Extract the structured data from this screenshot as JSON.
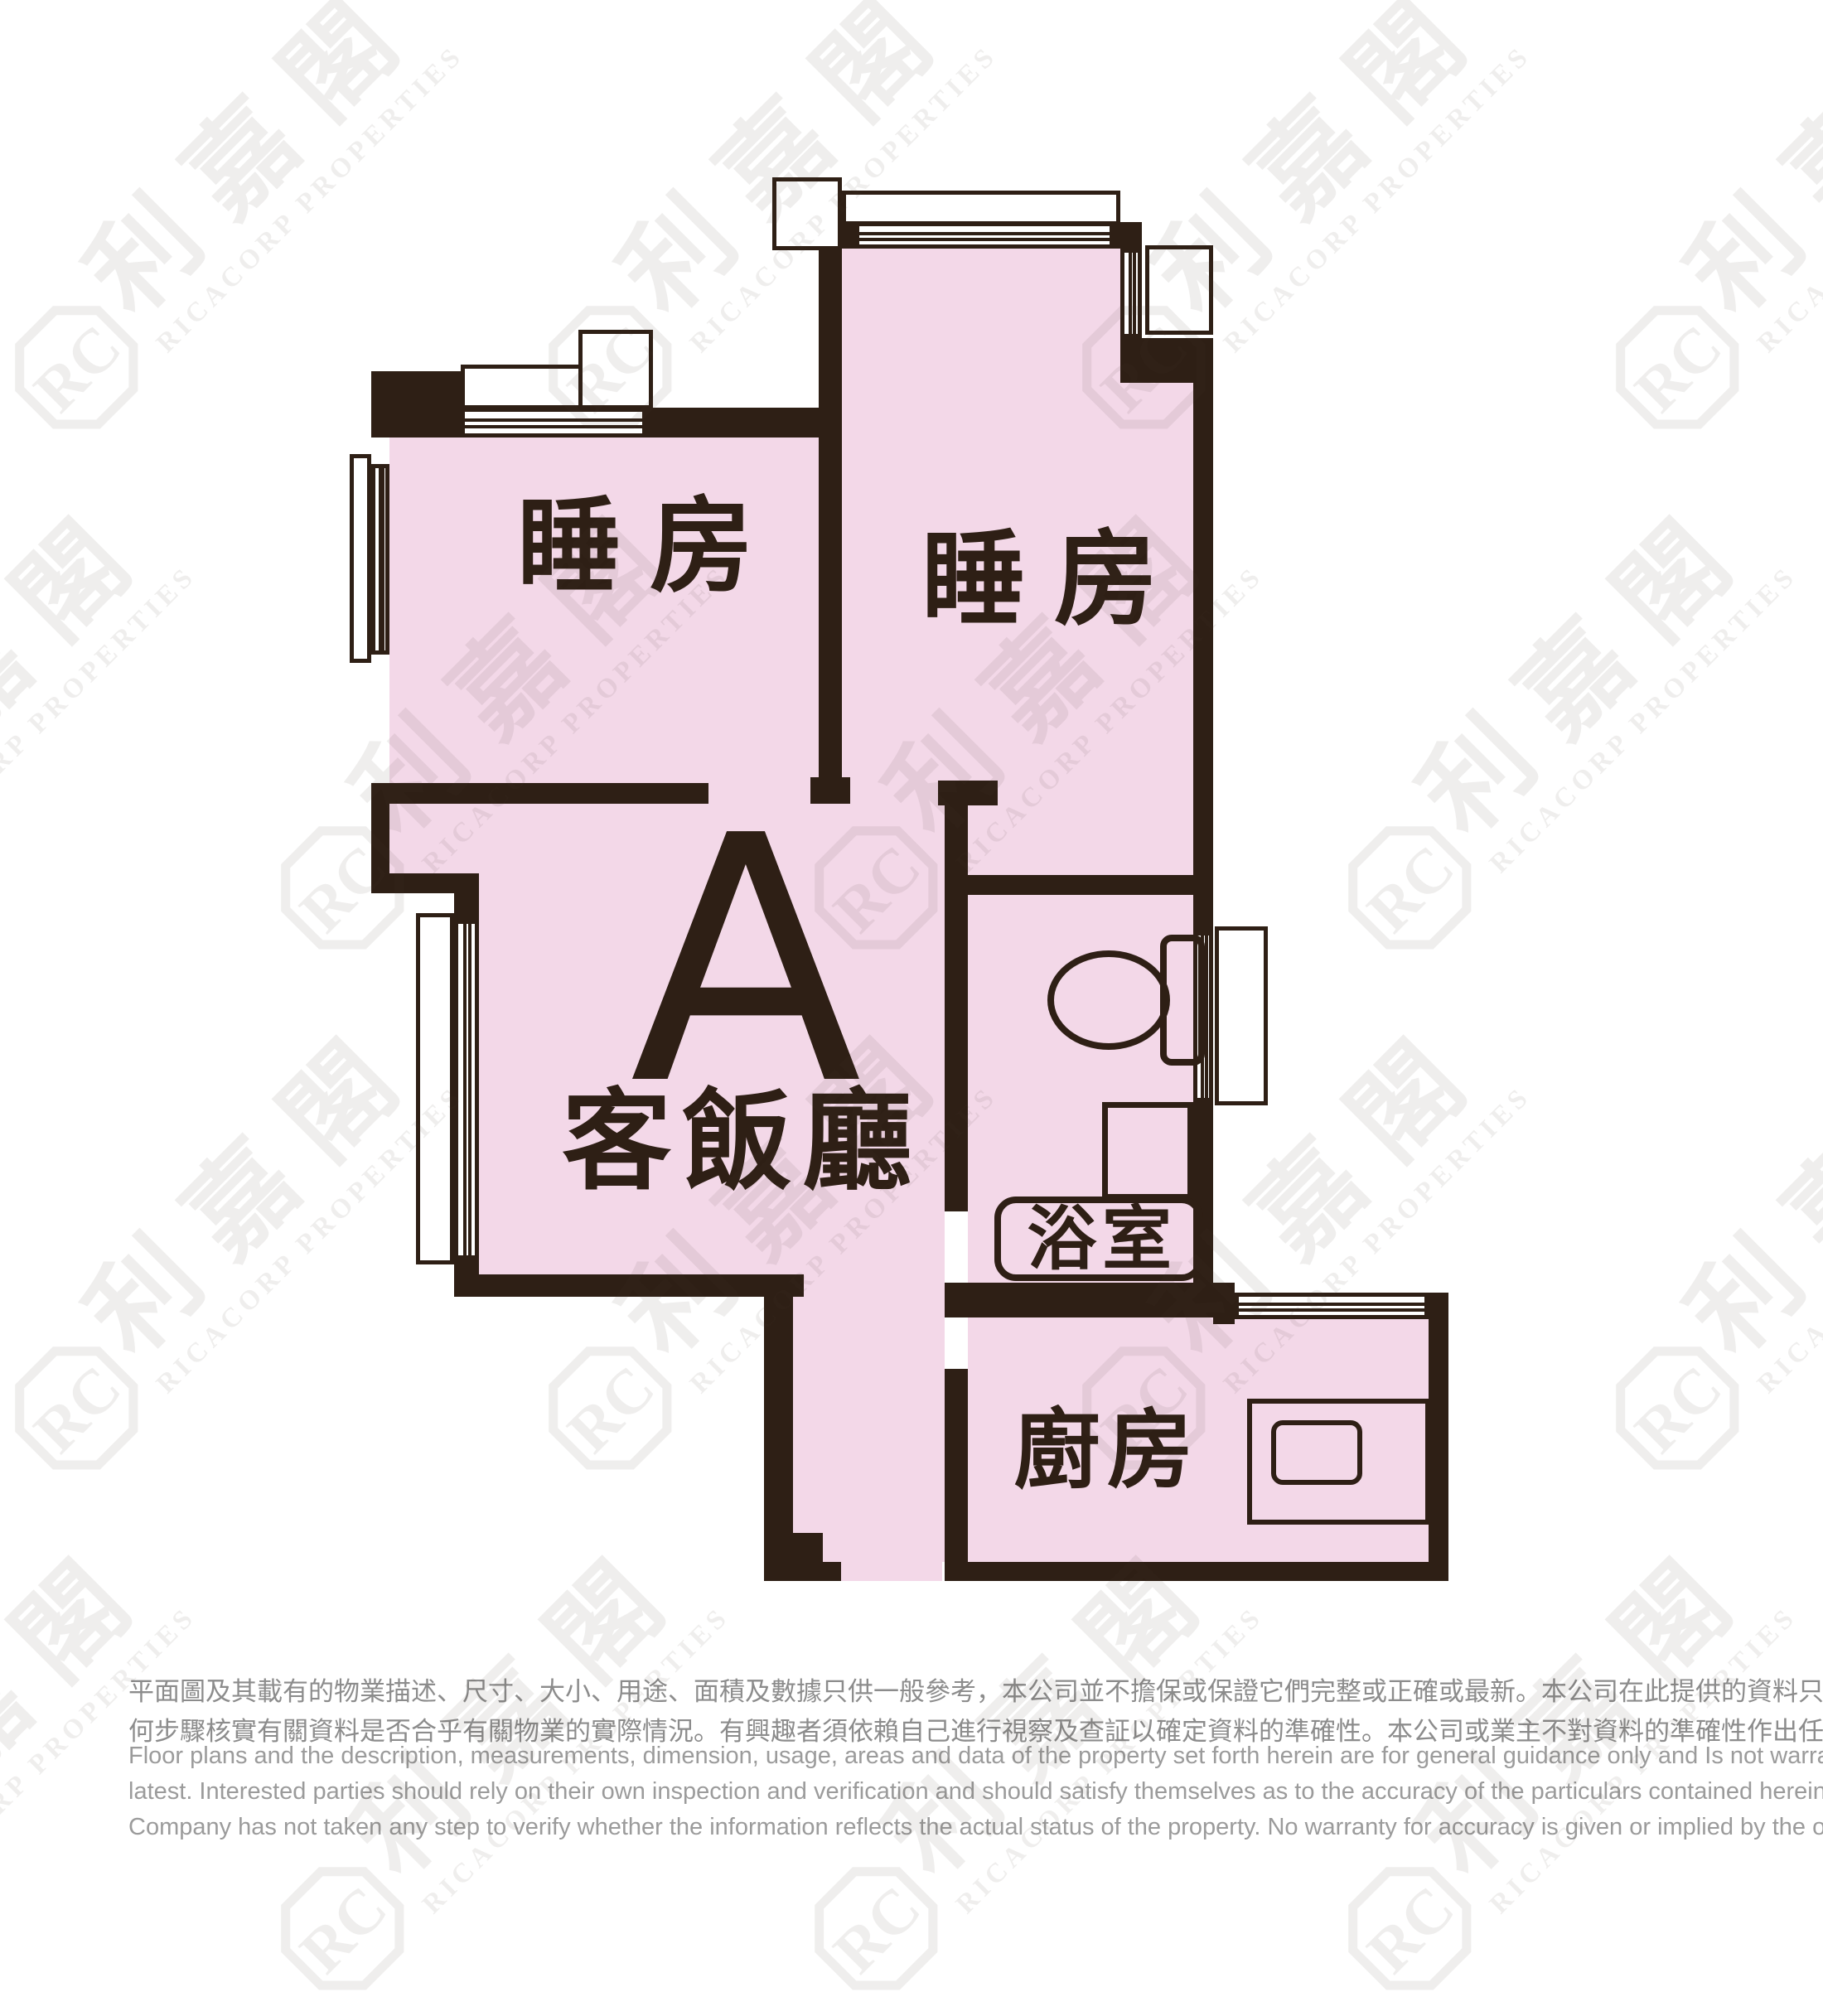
{
  "colors": {
    "wall": "#2e1f15",
    "room_fill": "#f3d8e8",
    "watermark": "rgba(70,58,50,0.085)",
    "disclaimer_zh": "#8c8c8c",
    "disclaimer_en": "#9b9b9b"
  },
  "watermark": {
    "logo_text": "RC",
    "name_cn": "利嘉閣",
    "name_en": "RICACORP PROPERTIES"
  },
  "plan": {
    "unit_label": "A",
    "rooms": {
      "bedroom_left": "睡房",
      "bedroom_right": "睡房",
      "living_dining": "客飯廳",
      "bathroom": "浴室",
      "kitchen": "廚房"
    }
  },
  "disclaimer": {
    "zh_lines": [
      "平面圖及其載有的物業描述、尺寸、大小、用途、面積及數據只供一般參考，本公司並不擔保或保證它們完整或正確或最新。本公司在此提供的資料只供閣下參考，本公司並無採取任",
      "何步驟核實有關資料是否合乎有關物業的實際情況。有興趣者須依賴自己進行視察及查証以確定資料的準確性。本公司或業主不對資料的準確性作出任何明示或隱含的保證。"
    ],
    "en_lines": [
      "Floor plans and the description, measurements, dimension, usage, areas and data of the property set forth herein are for general guidance only and Is not warranted or guaranteed to be complete or correct or the",
      "latest. Interested parties should rely on their own inspection and verification and should satisfy themselves as to the accuracy of the particulars contained herein which are provided by us for information only.  Our",
      "Company has not taken any step to verify whether the information reflects the actual status of the property.  No warranty for accuracy is given or implied by the owners or us."
    ]
  }
}
